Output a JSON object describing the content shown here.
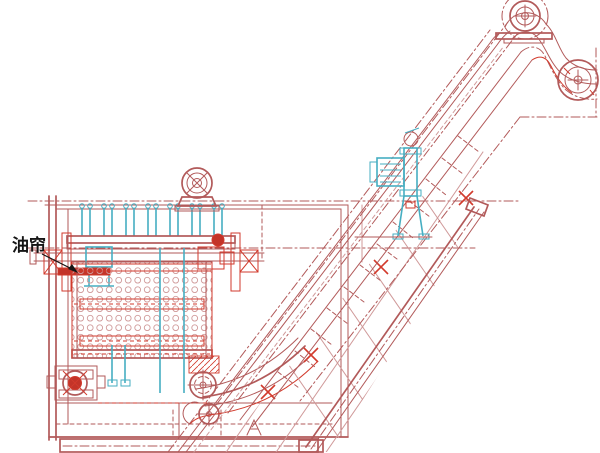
{
  "diagram": {
    "oil_curtain_label": "油帘"
  },
  "colors": {
    "background": "#ffffff",
    "main": "#b25a5a",
    "main_light": "#d09a9a",
    "accent": "#d23a2c",
    "accent_fill": "#c33429",
    "cyan": "#46aec2",
    "text": "#151515"
  }
}
